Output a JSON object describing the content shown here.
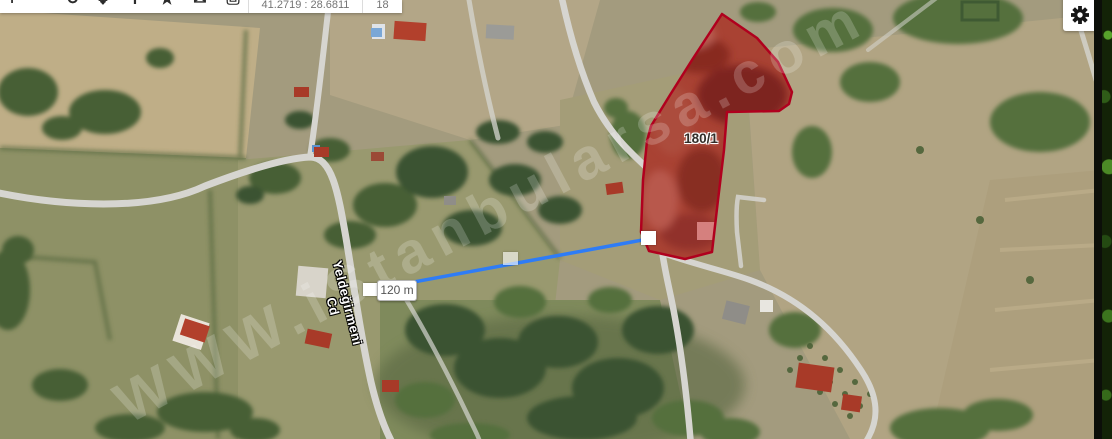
{
  "toolbar": {
    "coordinates": "41.2719 : 28.6811",
    "zoom_level": "18",
    "icons": [
      {
        "name": "zoom-in",
        "glyph": "+"
      },
      {
        "name": "zoom-out",
        "glyph": "−"
      },
      {
        "name": "refresh",
        "glyph": "↺"
      },
      {
        "name": "pan",
        "glyph": "✥"
      },
      {
        "name": "info",
        "glyph": "i"
      },
      {
        "name": "favorite",
        "glyph": "★"
      },
      {
        "name": "message",
        "glyph": "✉"
      },
      {
        "name": "print",
        "glyph": "⎙"
      }
    ]
  },
  "map": {
    "parcel_label": "180/1",
    "measurement_label": "120 m",
    "road_label": "Yeldeğirmeni Cd",
    "road_label_partial": "i Cd",
    "watermark": "WWW.iStanbularsa.com",
    "colors": {
      "parcel_stroke": "#b0001e",
      "parcel_fill": "rgba(205,0,25,0.28)",
      "measure_line": "#2e7cf6",
      "road": "#d6d5d0",
      "field_tan": "#b3a687",
      "field_olive": "#99996f"
    }
  }
}
